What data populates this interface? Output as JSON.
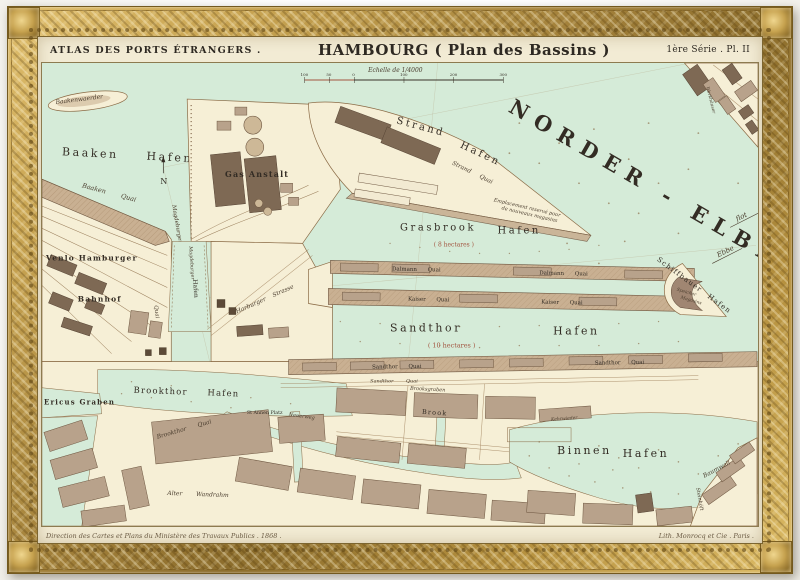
{
  "header": {
    "series": "ATLAS DES PORTS ÉTRANGERS .",
    "title": "HAMBOURG ( Plan des Bassins )",
    "plate": "1ère Série . Pl. II"
  },
  "scale": {
    "label": "Echelle de 1/4000",
    "ticks": [
      "100",
      "50",
      "0",
      "100",
      "200",
      "300"
    ]
  },
  "labels": {
    "norder_elbe": "NORDER - ELBE",
    "flot": "flot",
    "ebbe": "Ebbe",
    "north": "N",
    "baakenwaerder": "Baakenwaerder",
    "baaken_hafen": "Baaken Hafen",
    "baaken_quai": "Baaken Quai",
    "venlo_hamburger": "Venlo Hamburger",
    "bahnhof": "Bahnhof",
    "gas_anstalt": "Gas Anstalt",
    "magdeburger_street": "Magdeburger",
    "magdeburger_quai": "Quai",
    "magdeburger_hafen_1": "Magdeburger",
    "magdeburger_hafen_2": "Hafen",
    "strasse_east": "Strasse",
    "harburger_strasse": "Harburger Strasse",
    "strand": "Strand",
    "strand_hafen_2": "Hafen",
    "strand_quai": "Strand Quai",
    "emplacement_1": "Emplacement reservé pour",
    "emplacement_2": "de nouveaux magasins",
    "grasbrook": "Grasbrook",
    "grasbrook_hafen_2": "Hafen",
    "grasbrook_area": "( 8 hectares )",
    "dalmann_quai_1": "Dalmann Quai",
    "dalmann_quai_2": "Dalmann Quai",
    "kaiser_quai_1": "Kaiser Quai",
    "kaiser_quai_2": "Kaiser Quai",
    "schiffbauer_hafen": "Schiffbauer Hafen",
    "speicher": "Speicher",
    "magasins": "Magasins",
    "sandthor": "Sandthor",
    "sandthor_hafen_2": "Hafen",
    "sandthor_area": "( 10 hectares )",
    "sandthor_quai_1": "Sandthor Quai",
    "sandthor_quai_2": "Sandthor Quai",
    "sandthor_quai_3": "Sandthor Quai",
    "brookthor_hafen": "Brookthor Hafen",
    "brookthor_quai": "Brookthor Quai",
    "ericus_graben": "Ericus Graben",
    "st_annen_platz": "St Annen Platz",
    "neuerweg": "Neuerweg",
    "brooksgraben": "Brooksgraben",
    "brook": "Brook",
    "alter_wandrahm": "Alter Wandrahm",
    "binnen": "Binnen",
    "binnen_hafen_2": "Hafen",
    "baumwall": "Baumwall",
    "kehrwieder": "Kehrwieder",
    "steinhoeft": "Steinhöft",
    "werkhaeuser": "Werkhäuser"
  },
  "footer": {
    "left": "Direction des Cartes et Plans du Ministère des Travaux Publics . 1868 .",
    "right": "Lith. Monrocq et Cie . Paris ."
  },
  "colors": {
    "frame_gold": "#c8a452",
    "paper": "#f2ebd4",
    "water": "#d5ebd8",
    "land": "#f6efd6",
    "building": "#b8a28b",
    "ink": "#332c24",
    "accent_red": "#a2543f"
  }
}
